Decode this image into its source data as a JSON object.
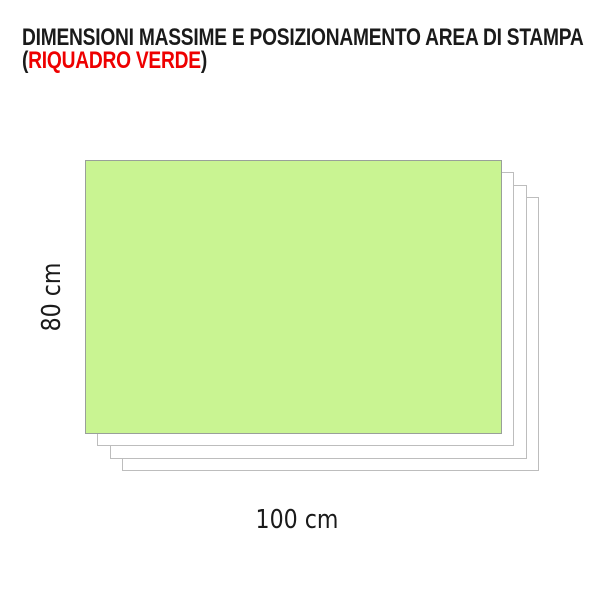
{
  "header": {
    "title_line1": "DIMENSIONI MASSIME E POSIZIONAMENTO AREA DI STAMPA",
    "title_line2_prefix": "(",
    "title_line2_highlight": "RIQUADRO VERDE",
    "title_line2_suffix": ")"
  },
  "diagram": {
    "height_label": "80 cm",
    "width_label": "100 cm",
    "sheet_count": 3
  },
  "colors": {
    "background": "#ffffff",
    "title_text": "#1a1a1a",
    "highlight_red": "#ee0000",
    "print_area_fill": "#c9f492",
    "print_area_border": "#99a099",
    "sheet_fill": "#ffffff",
    "sheet_border": "#bdbdbd"
  }
}
